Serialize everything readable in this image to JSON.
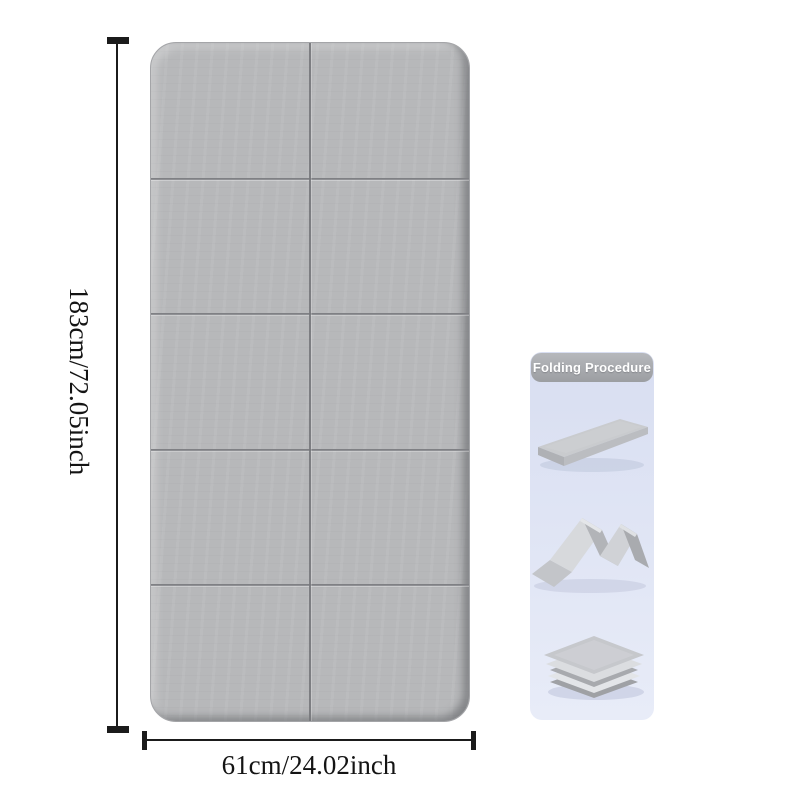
{
  "canvas": {
    "background": "#ffffff"
  },
  "mat": {
    "description": "foldable exercise mat shown flat, 2 columns x 5 rows of fold panels",
    "color": "#b7b8ba",
    "fold_line_color": "#77787c",
    "columns": 2,
    "rows": 5
  },
  "dimensions": {
    "height_label": "183cm/72.05inch",
    "width_label": "61cm/24.02inch",
    "line_color": "#1b1b1b"
  },
  "folding_panel": {
    "title": "Folding Procedure",
    "title_color": "#ffffff",
    "banner_color": "#9c9ea2",
    "background_top": "#d8def1",
    "background_bottom": "#e8ecf8",
    "steps": [
      {
        "name": "flat-unfolded-mat"
      },
      {
        "name": "accordion-half-folded-mat"
      },
      {
        "name": "fully-folded-stacked-mat"
      }
    ]
  }
}
